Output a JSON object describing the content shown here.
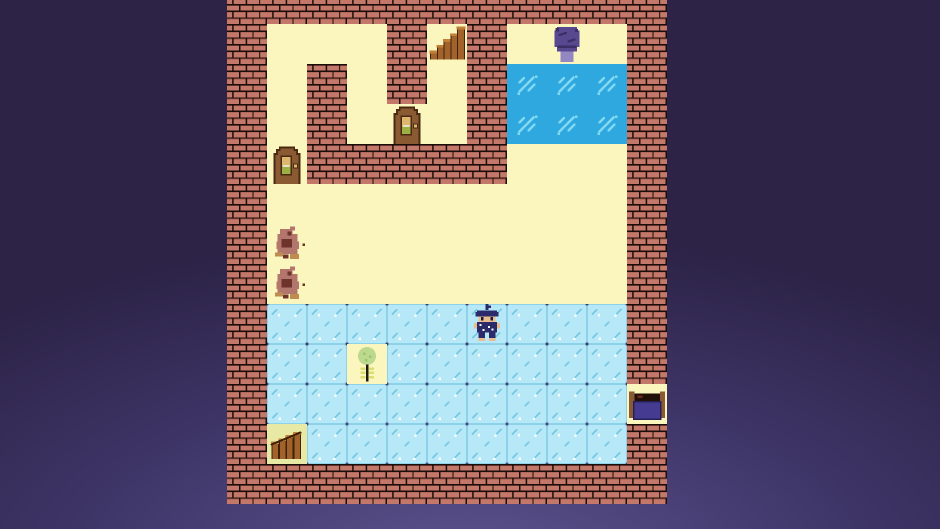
{
  "scene": {
    "name": "retro-rpg-dungeon-room",
    "viewport": {
      "width": 940,
      "height": 529
    },
    "board": {
      "left": 227,
      "top": -16,
      "cols": 11,
      "rows": 13,
      "tile_size": 40
    }
  },
  "palette": {
    "bg_dark": "#2c2347",
    "bg_mid": "#3f3669",
    "bg_glow": "#5d5490",
    "mortar": "#1b0d0b",
    "brick": "#c4786a",
    "brick_shade": "#9e5c4e",
    "floor": "#faf6bd",
    "gate_floor": "#e9e9a6",
    "ice": "#b6e8f7",
    "ice_edge": "#8ed2ea",
    "ice_mark": "#79c8e2",
    "water": "#2fa7df",
    "water_sparkle": "#7fd9f3",
    "wood": "#a2622c",
    "wood_light": "#c08038",
    "wood_dark": "#3f2208",
    "door_wood": "#8a5a33",
    "door_outline": "#4a2a12",
    "door_panel_top": "#dcb76d",
    "door_panel_bottom": "#9cb043",
    "door_glint": "#e8e3c8",
    "slime_body": "#57488f",
    "slime_dark": "#3a2f66",
    "slime_base": "#9486c2",
    "monster_body": "#b3766c",
    "monster_dark": "#6e332a",
    "monster_ochre": "#bd8c4e",
    "player_navy": "#2b2b6b",
    "player_skin": "#e9bd8e",
    "player_eye": "#1a1a3a",
    "player_dot": "#ffffff",
    "bed_blanket": "#453c92",
    "bed_outline": "#262058",
    "bed_post": "#8a5a35",
    "bed_pillow": "#201008",
    "plant_canopy": "#bcd98d",
    "plant_speck": "#9ec56d",
    "plant_leaf": "#d9df6e",
    "plant_stem": "#1a1a10"
  },
  "legend": {
    "W": "brick-wall",
    "C": "floor",
    "I": "ice",
    "A": "water",
    "G": "gate-floor"
  },
  "tilemap": [
    "WWWWWWWWWWW",
    "WCCCWCWCCCW",
    "WCWCWCWAAAW",
    "WCWCCCWAAAW",
    "WCWWWWWCCCW",
    "WCCCCCCCCCW",
    "WCCCCCCCCCW",
    "WCCCCCCCCCW",
    "WIIIIIIIIIW",
    "WIICIIIIIIW",
    "WIIIIIIIIIC",
    "WGIIIIIIIIW",
    "WWWWWWWWWWW"
  ],
  "entities": [
    {
      "type": "staircase",
      "name": "wooden-staircase",
      "col": 5,
      "row": 1
    },
    {
      "type": "slime",
      "name": "purple-slime",
      "col": 8,
      "row": 1
    },
    {
      "type": "door",
      "name": "arched-door-upper",
      "col": 4,
      "row": 3
    },
    {
      "type": "door",
      "name": "arched-door-left",
      "col": 1,
      "row": 4
    },
    {
      "type": "monster",
      "name": "brown-monster-1",
      "col": 1,
      "row": 6
    },
    {
      "type": "monster",
      "name": "brown-monster-2",
      "col": 1,
      "row": 7
    },
    {
      "type": "player",
      "name": "player-character",
      "col": 6,
      "row": 8
    },
    {
      "type": "plant",
      "name": "sapling",
      "col": 3,
      "row": 9
    },
    {
      "type": "bed",
      "name": "bed",
      "col": 10,
      "row": 10
    },
    {
      "type": "gate",
      "name": "wooden-gate",
      "col": 1,
      "row": 11
    }
  ]
}
